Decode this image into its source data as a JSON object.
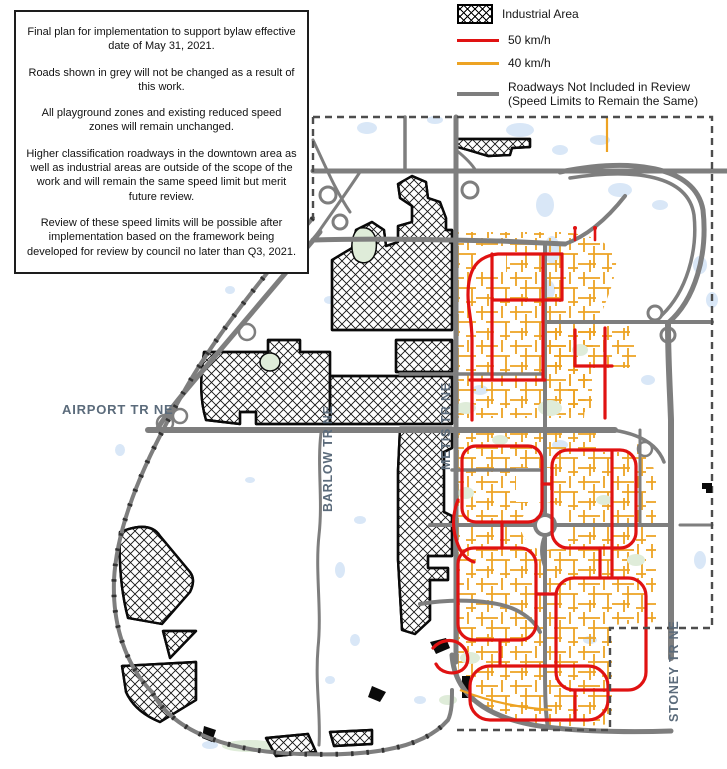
{
  "notes_box": {
    "paragraphs": [
      "Final plan for implementation to support bylaw effective date of May 31, 2021.",
      "Roads shown in grey will not be changed as a result of this work.",
      "All playground zones and existing reduced speed zones will remain unchanged.",
      "Higher classification roadways in the downtown area as well as industrial areas are outside of the scope of the work and will remain the same speed limit but merit future review.",
      "Review of these speed limits will be possible after implementation based on the framework being developed for review by council no later than Q3, 2021."
    ]
  },
  "legend": {
    "items": [
      {
        "label": "Industrial Area",
        "swatch": "hatch",
        "color": "#000000"
      },
      {
        "label": "50 km/h",
        "swatch": "line",
        "color": "#e01212"
      },
      {
        "label": "40 km/h",
        "swatch": "line",
        "color": "#eda323"
      },
      {
        "label": "Roadways Not Included in Review",
        "label_line2": "(Speed Limits to Remain the Same)",
        "swatch": "line",
        "color": "#7e7e7e"
      }
    ]
  },
  "map": {
    "labels": {
      "airport": "AIRPORT TR NE",
      "barlow": "BARLOW TR NE",
      "metis": "METIS TR NE",
      "stoney": "STONEY TR NE"
    },
    "colors": {
      "speed_50": "#e01212",
      "speed_40": "#eda323",
      "roadway_grey": "#7e7e7e",
      "study_boundary": "#4d4d4d",
      "water": "#d9e7f7",
      "park": "#dfecd9",
      "road_label_text": "#5b6b7b"
    }
  }
}
